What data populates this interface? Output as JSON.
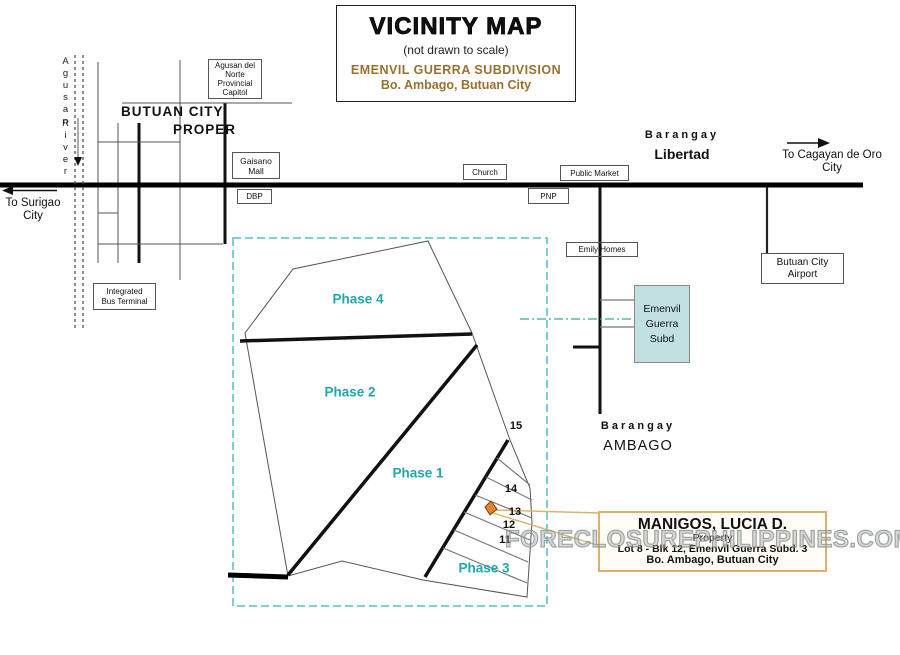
{
  "title_box": {
    "title": "VICINITY MAP",
    "subtitle": "(not drawn to scale)",
    "subdivision": "EMENVIL GUERRA SUBDIVISION",
    "location": "Bo. Ambago, Butuan City"
  },
  "city": {
    "name_line1": "BUTUAN CITY",
    "name_line2": "PROPER"
  },
  "river": {
    "word1": "Agusan",
    "word2": "River"
  },
  "directions": {
    "surigao_line1": "To Surigao",
    "surigao_line2": "City",
    "cagayan_line1": "To  Cagayan de Oro",
    "cagayan_line2": "City"
  },
  "barangays": {
    "libertad_prefix": "Barangay",
    "libertad_name": "Libertad",
    "ambago_prefix": "Barangay",
    "ambago_name": "AMBAGO"
  },
  "places": {
    "capitol": {
      "line1": "Agusan del",
      "line2": "Norte",
      "line3": "Provincial",
      "line4": "Capitol"
    },
    "gaisano": {
      "line1": "Gaisano",
      "line2": "Mall"
    },
    "dbp": {
      "line1": "DBP"
    },
    "church": {
      "line1": "Church"
    },
    "public_market": {
      "line1": "Public Market"
    },
    "pnp": {
      "line1": "PNP"
    },
    "emily_homes": {
      "line1": "Emily Homes"
    },
    "airport": {
      "line1": "Butuan City",
      "line2": "Airport"
    },
    "bus_terminal": {
      "line1": "Integrated",
      "line2": "Bus Terminal"
    },
    "emenvil_subd": {
      "line1": "Emenvil",
      "line2": "Guerra",
      "line3": "Subd"
    }
  },
  "subdivision_map": {
    "phase1": "Phase 1",
    "phase2": "Phase 2",
    "phase3": "Phase 3",
    "phase4": "Phase 4",
    "lot15": "15",
    "lot14": "14",
    "lot13": "13",
    "lot12": "12",
    "lot11": "11"
  },
  "callout": {
    "owner": "MANIGOS, LUCIA D.",
    "line2": "Property",
    "line3": "Lot 8 - Blk 12, Emenvil Guerra Subd. 3",
    "line4": "Bo. Ambago, Butuan City"
  },
  "watermark": "FORECLOSUREPHILIPPINES.COM",
  "colors": {
    "teal_text": "#1fa9ad",
    "teal_dash": "#4fc3c7",
    "dashdot_line": "#3aa89d",
    "brown_text": "#97712e",
    "marker_fill": "#e0862f",
    "marker_stroke": "#8a3c10",
    "callout_border": "#d9b36b",
    "watermark_gray": "#9aa0a0",
    "emenvil_fill": "#c2e0e2"
  }
}
